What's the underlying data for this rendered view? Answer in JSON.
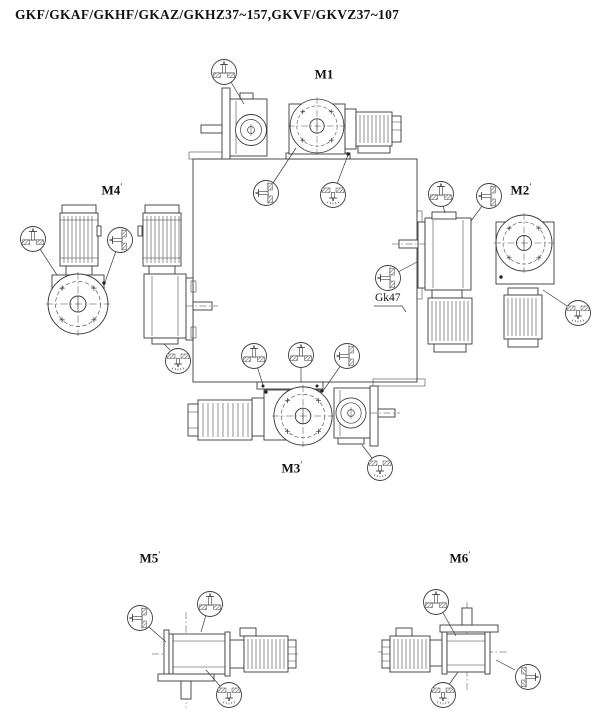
{
  "title": "GKF/GKAF/GKHF/GKAZ/GKHZ37~157,GKVF/GKVZ37~107",
  "positions": {
    "m1": {
      "label": "M1",
      "mark": ""
    },
    "m2": {
      "label": "M2",
      "mark": "′"
    },
    "m3": {
      "label": "M3",
      "mark": "′"
    },
    "m4": {
      "label": "M4",
      "mark": "′"
    },
    "m5": {
      "label": "M5",
      "mark": "′"
    },
    "m6": {
      "label": "M6",
      "mark": "′"
    }
  },
  "callouts": {
    "gearbox_size_label": "Gk47"
  },
  "icons": {
    "breather": "breather-plug-icon",
    "oil_level": "oil-level-plug-icon",
    "drain": "oil-drain-plug-icon"
  },
  "colors": {
    "line": "#3b3b3b",
    "text": "#111111",
    "background": "#ffffff"
  }
}
